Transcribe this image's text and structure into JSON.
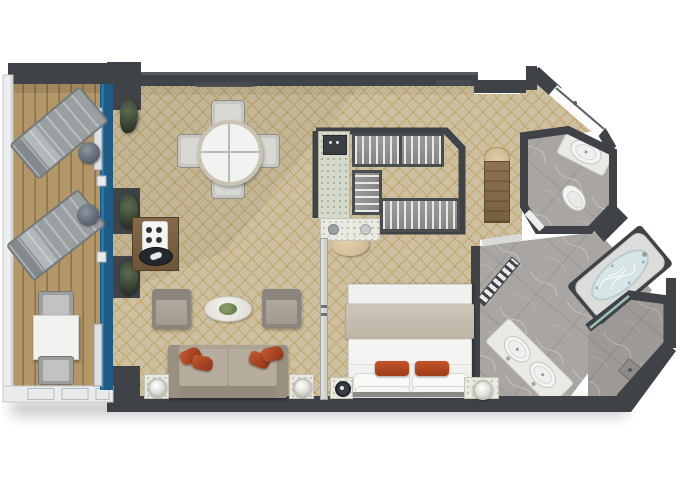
{
  "scene": {
    "label": "cruise-ship-suite-floor-plan-top-view"
  },
  "colors": {
    "wall": "#3f4347",
    "wallBevel": "#565b5f",
    "carpet": "#cdc0a0",
    "carpetLine": "#bf9a52",
    "deck": "#b39768",
    "deckLine": "#8c7450",
    "railing": "#eceef0",
    "glass": "#1e5c86",
    "glassLight": "#2f80b0",
    "marble": "#a8a5a2",
    "marbleVein": "#cfccc8",
    "counter": "#eae9e5",
    "fixture": "#f4f4f2",
    "water": "#d7e5e7",
    "sofa": "#ada393",
    "cushion": "#b7ad9e",
    "accentPillow": "#b34a28",
    "wood": "#7d6546",
    "wardrobe": "#919190",
    "wardrobeStripe": "#e8e8e6",
    "bedThrow": "#c5bcae",
    "tan": "#d9c69c",
    "plant": "#46543f"
  },
  "rooms": [
    {
      "name": "balcony",
      "items": [
        "lounge-chair",
        "lounge-chair",
        "round-side-table",
        "round-side-table",
        "square-table",
        "balcony-chair",
        "balcony-chair",
        "railing",
        "sliding-glass-doors"
      ]
    },
    {
      "name": "living-room",
      "items": [
        "round-dining-table",
        "dining-chair",
        "dining-chair",
        "dining-chair",
        "dining-chair",
        "minibar-console",
        "armchair",
        "armchair",
        "oval-coffee-table",
        "sofa",
        "accent-pillow",
        "accent-pillow",
        "accent-pillow",
        "accent-pillow",
        "lamp-table",
        "lamp-table",
        "plant",
        "plant",
        "plant"
      ]
    },
    {
      "name": "wardrobe-closet",
      "items": [
        "hanging-rail",
        "hanging-rail",
        "hanging-rail",
        "marble-bench",
        "safe"
      ]
    },
    {
      "name": "bedroom",
      "items": [
        "double-bed",
        "bed-throw",
        "accent-pillow",
        "accent-pillow",
        "nightstand",
        "nightstand",
        "vanity-counter",
        "stool",
        "sliding-partition"
      ]
    },
    {
      "name": "entry-hall",
      "items": [
        "entry-door",
        "wood-bench",
        "half-round-table"
      ]
    },
    {
      "name": "wc",
      "items": [
        "toilet",
        "washbasin"
      ]
    },
    {
      "name": "bathroom",
      "items": [
        "double-washbasin-counter",
        "bathtub",
        "glass-door"
      ]
    },
    {
      "name": "shower",
      "items": [
        "floor-drain",
        "shower-fixture",
        "glass-screen"
      ]
    }
  ]
}
